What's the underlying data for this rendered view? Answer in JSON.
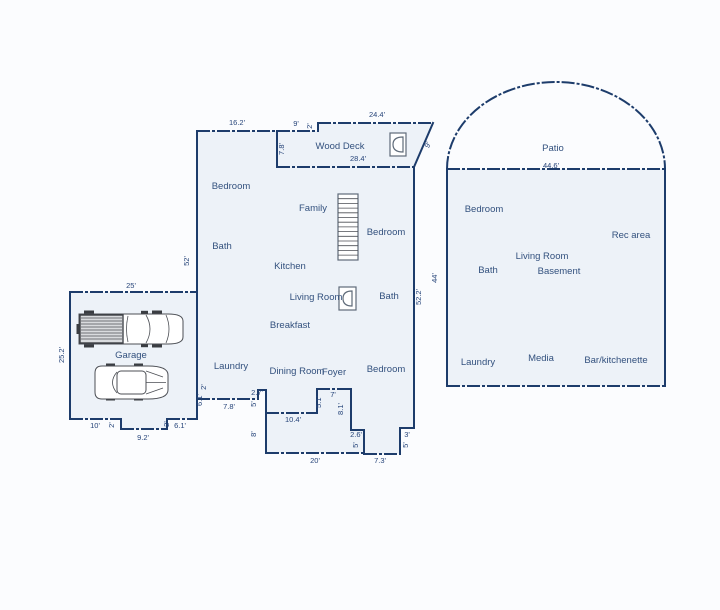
{
  "colors": {
    "background": "#fbfcfe",
    "wall": "#1d3c6b",
    "building_fill": "#edf2f8",
    "room_text": "#33517e",
    "dimension_text": "#27457a"
  },
  "rooms": [
    {
      "label": "Bedroom",
      "x": 231,
      "y": 189
    },
    {
      "label": "Family",
      "x": 313,
      "y": 211
    },
    {
      "label": "Bedroom",
      "x": 386,
      "y": 235
    },
    {
      "label": "Bath",
      "x": 222,
      "y": 249
    },
    {
      "label": "Kitchen",
      "x": 290,
      "y": 269
    },
    {
      "label": "Living Room",
      "x": 316,
      "y": 300
    },
    {
      "label": "Bath",
      "x": 389,
      "y": 299
    },
    {
      "label": "Breakfast",
      "x": 290,
      "y": 328
    },
    {
      "label": "Laundry",
      "x": 231,
      "y": 369
    },
    {
      "label": "Dining Room",
      "x": 297,
      "y": 374
    },
    {
      "label": "Foyer",
      "x": 334,
      "y": 375
    },
    {
      "label": "Bedroom",
      "x": 386,
      "y": 372
    },
    {
      "label": "Garage",
      "x": 131,
      "y": 358
    },
    {
      "label": "Wood Deck",
      "x": 340,
      "y": 149
    },
    {
      "label": "Patio",
      "x": 553,
      "y": 151
    },
    {
      "label": "Bedroom",
      "x": 484,
      "y": 212
    },
    {
      "label": "Rec area",
      "x": 631,
      "y": 238
    },
    {
      "label": "Living Room",
      "x": 542,
      "y": 259
    },
    {
      "label": "Bath",
      "x": 488,
      "y": 273
    },
    {
      "label": "Basement",
      "x": 559,
      "y": 274
    },
    {
      "label": "Laundry",
      "x": 478,
      "y": 365
    },
    {
      "label": "Media",
      "x": 541,
      "y": 361
    },
    {
      "label": "Bar/kitchenette",
      "x": 616,
      "y": 363
    }
  ],
  "dimensions": [
    {
      "label": "16.2'",
      "x": 237,
      "y": 125,
      "rotate": 0
    },
    {
      "label": "9'",
      "x": 296,
      "y": 126,
      "rotate": 0
    },
    {
      "label": "2'",
      "x": 312,
      "y": 126,
      "rotate": -90
    },
    {
      "label": "24.4'",
      "x": 377,
      "y": 117,
      "rotate": 0
    },
    {
      "label": "9'",
      "x": 430,
      "y": 146,
      "rotate": -62
    },
    {
      "label": "7.8'",
      "x": 284,
      "y": 149,
      "rotate": -90
    },
    {
      "label": "28.4'",
      "x": 358,
      "y": 161,
      "rotate": 0
    },
    {
      "label": "52'",
      "x": 189,
      "y": 261,
      "rotate": -90
    },
    {
      "label": "52.2'",
      "x": 421,
      "y": 297,
      "rotate": -90
    },
    {
      "label": "44'",
      "x": 437,
      "y": 278,
      "rotate": -90
    },
    {
      "label": "44.6'",
      "x": 551,
      "y": 168,
      "rotate": 0
    },
    {
      "label": "25'",
      "x": 131,
      "y": 288,
      "rotate": 0
    },
    {
      "label": "25.2'",
      "x": 64,
      "y": 355,
      "rotate": -90
    },
    {
      "label": "10'",
      "x": 95,
      "y": 428,
      "rotate": 0
    },
    {
      "label": "2'",
      "x": 114,
      "y": 425,
      "rotate": -90
    },
    {
      "label": "9.2'",
      "x": 143,
      "y": 440,
      "rotate": 0
    },
    {
      "label": "2'",
      "x": 169,
      "y": 424,
      "rotate": -90
    },
    {
      "label": "6.1'",
      "x": 180,
      "y": 428,
      "rotate": 0
    },
    {
      "label": "6.1'",
      "x": 202,
      "y": 400,
      "rotate": -90
    },
    {
      "label": "2'",
      "x": 206,
      "y": 387,
      "rotate": -90
    },
    {
      "label": "7.8'",
      "x": 229,
      "y": 409,
      "rotate": 0
    },
    {
      "label": "2.7'",
      "x": 257,
      "y": 395,
      "rotate": 0
    },
    {
      "label": "5'",
      "x": 256,
      "y": 404,
      "rotate": -90
    },
    {
      "label": "8'",
      "x": 256,
      "y": 434,
      "rotate": -90
    },
    {
      "label": "10.4'",
      "x": 293,
      "y": 422,
      "rotate": 0
    },
    {
      "label": "5.1'",
      "x": 321,
      "y": 402,
      "rotate": -90
    },
    {
      "label": "7'",
      "x": 333,
      "y": 397,
      "rotate": 0
    },
    {
      "label": "8.1'",
      "x": 343,
      "y": 409,
      "rotate": -90
    },
    {
      "label": "2.6'",
      "x": 356,
      "y": 437,
      "rotate": 0
    },
    {
      "label": "5'",
      "x": 358,
      "y": 445,
      "rotate": -90
    },
    {
      "label": "20'",
      "x": 315,
      "y": 463,
      "rotate": 0
    },
    {
      "label": "7.3'",
      "x": 380,
      "y": 463,
      "rotate": 0
    },
    {
      "label": "3'",
      "x": 407,
      "y": 437,
      "rotate": 0
    },
    {
      "label": "5'",
      "x": 408,
      "y": 445,
      "rotate": -90
    }
  ]
}
